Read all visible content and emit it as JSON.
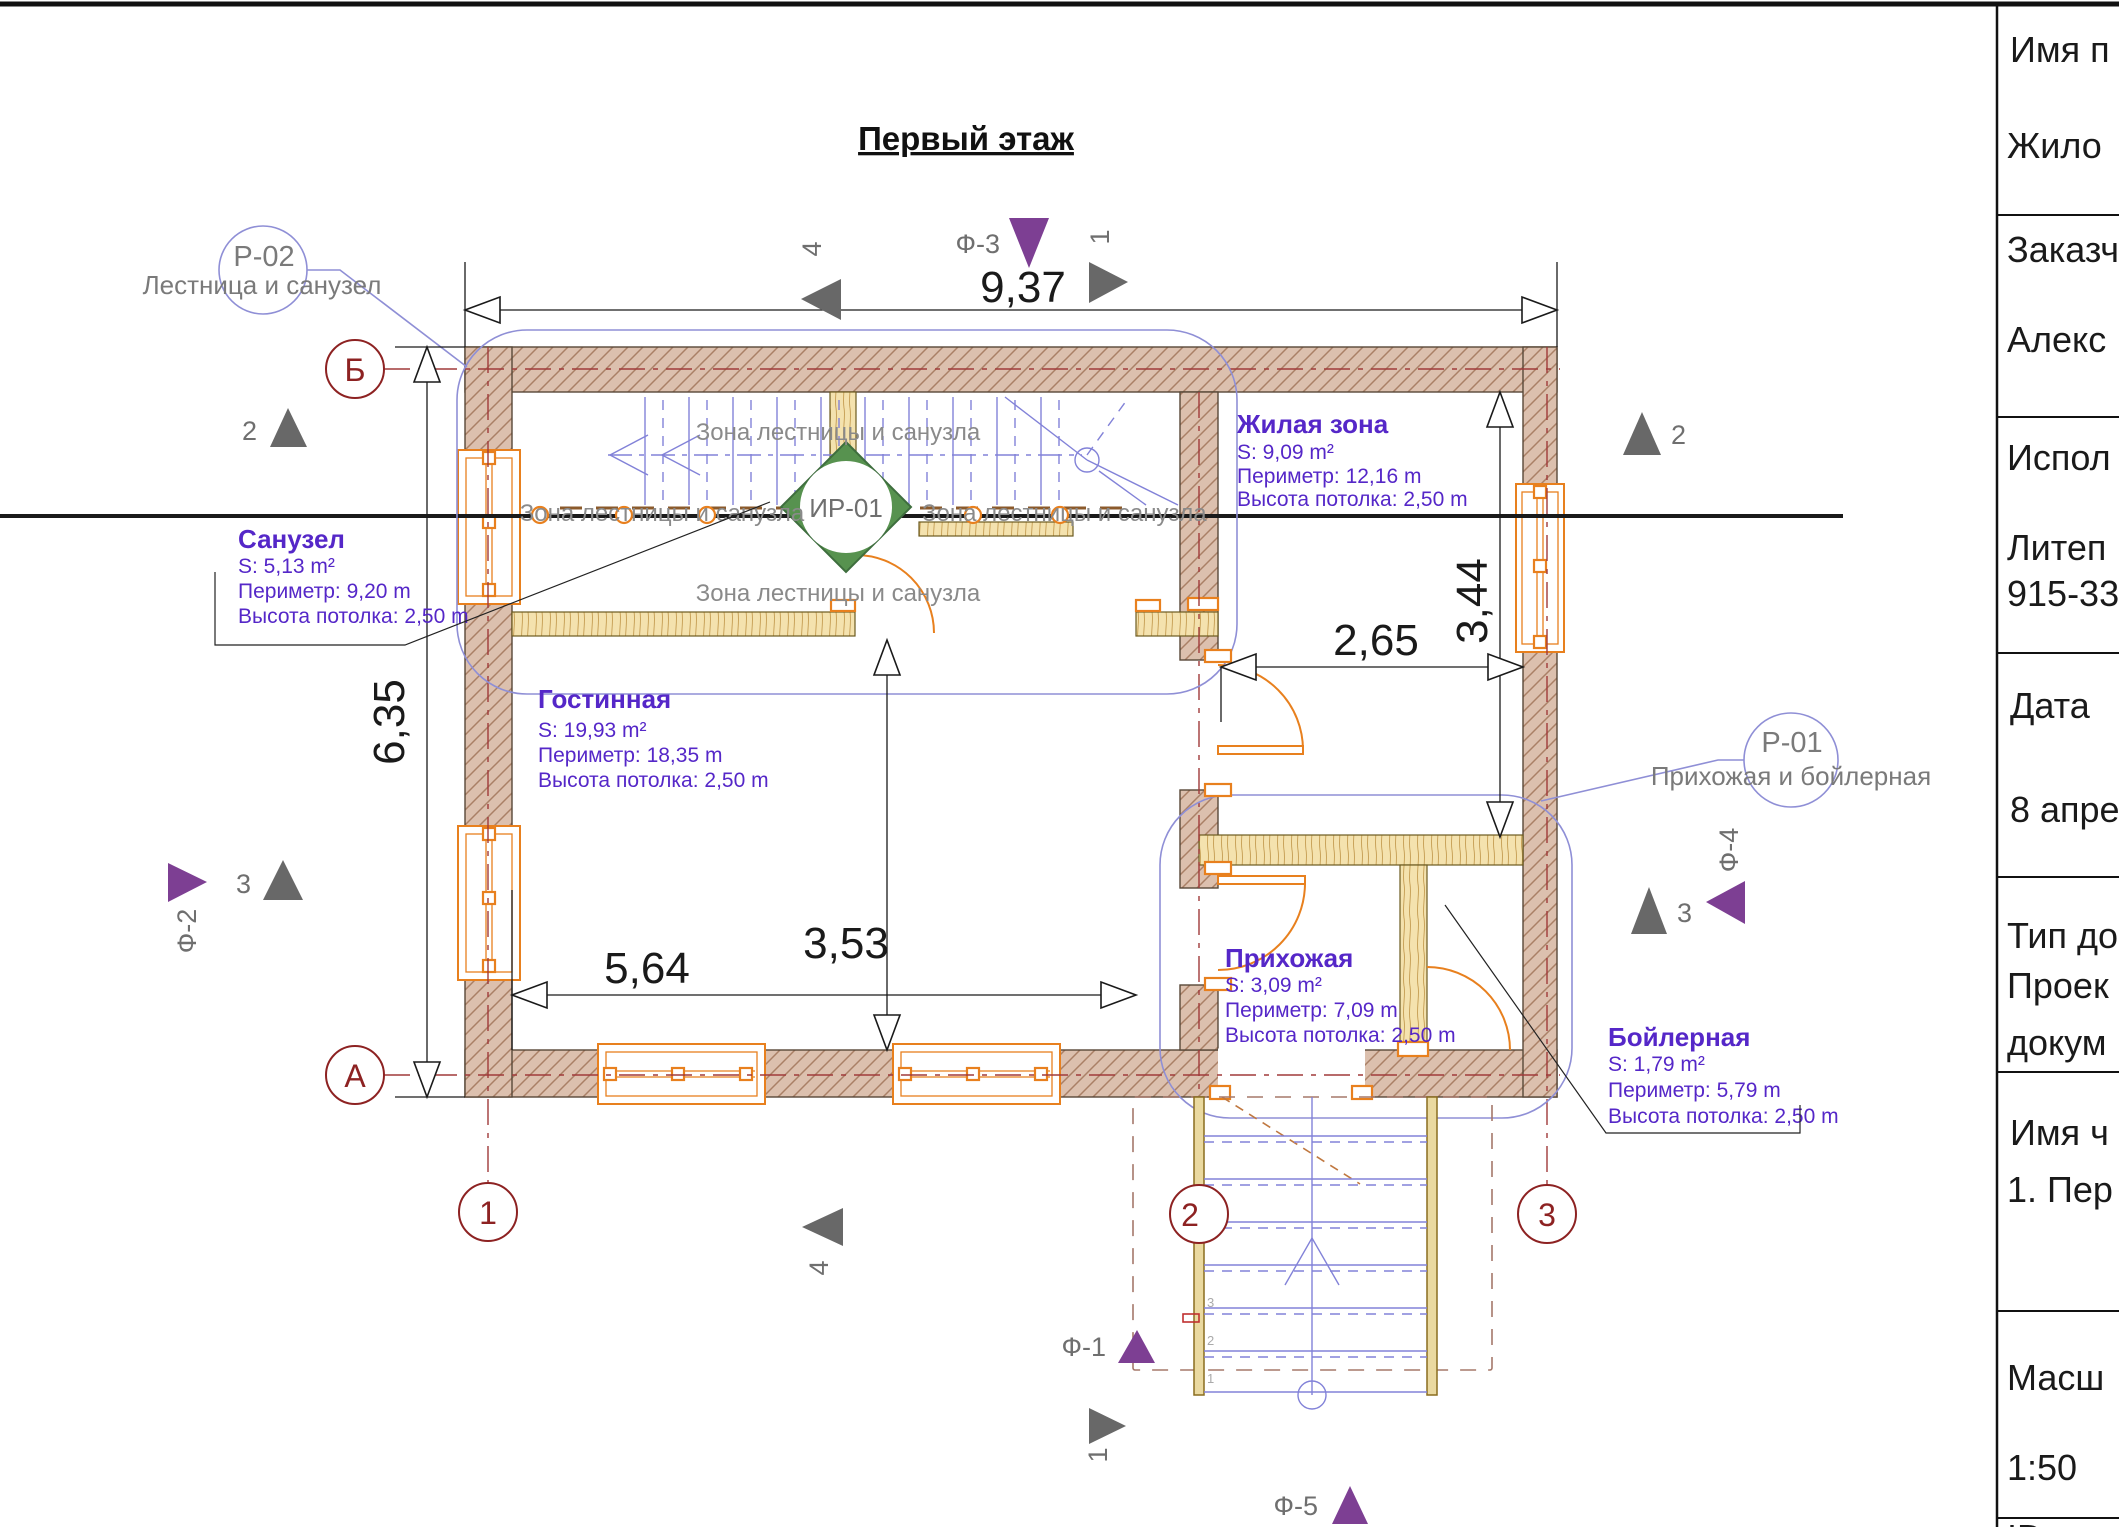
{
  "sheet_title": "Первый этаж",
  "titleblock": {
    "rows": [
      {
        "label": "Имя п",
        "value": "Жило",
        "value2": ""
      },
      {
        "label": "Заказч",
        "value": "Алекс",
        "value2": ""
      },
      {
        "label": "Испол",
        "value": "Литеп",
        "value2": "915-33"
      },
      {
        "label": "Дата",
        "value": "8 апре",
        "value2": ""
      },
      {
        "label": "Тип до",
        "value": "Проек",
        "value2": "докум"
      },
      {
        "label": "Имя ч",
        "value": "1. Пер",
        "value2": ""
      },
      {
        "label": "Масш",
        "value": "1:50",
        "value2": ""
      },
      {
        "label": "ID ма",
        "value": "",
        "value2": ""
      }
    ]
  },
  "rooms": {
    "sanuzel": {
      "name": "Санузел",
      "area": "S: 5,13 m²",
      "perimeter": "Периметр: 9,20 m",
      "ceiling": "Высота потолка: 2,50 m"
    },
    "gostinnaya": {
      "name": "Гостинная",
      "area": "S: 19,93 m²",
      "perimeter": "Периметр: 18,35 m",
      "ceiling": "Высота потолка: 2,50 m"
    },
    "zhilaya": {
      "name": "Жилая зона",
      "area": "S: 9,09 m²",
      "perimeter": "Периметр: 12,16 m",
      "ceiling": "Высота потолка: 2,50 m"
    },
    "prihozhaya": {
      "name": "Прихожая",
      "area": "S: 3,09 m²",
      "perimeter": "Периметр: 7,09 m",
      "ceiling": "Высота потолка: 2,50 m"
    },
    "boylernaya": {
      "name": "Бойлерная",
      "area": "S: 1,79 m²",
      "perimeter": "Периметр: 5,79 m",
      "ceiling": "Высота потолка: 2,50 m"
    }
  },
  "dims": {
    "top_width": "9,37",
    "left_height": "6,35",
    "living_right_height": "3,44",
    "hall_width": "2,65",
    "gost_width": "5,64",
    "gost_height": "3,53"
  },
  "axes": {
    "a": "А",
    "b": "Б",
    "n1": "1",
    "n2": "2",
    "n3": "3"
  },
  "callouts": {
    "p02": {
      "id": "Р-02",
      "label": "Лестница и санузел"
    },
    "p01": {
      "id": "Р-01",
      "label": "Прихожая и бойлерная"
    },
    "ir01": "ИР-01"
  },
  "zone_label": "Зона лестницы и санузла",
  "view_markers": {
    "m1": "1",
    "m2": "2",
    "m3": "3",
    "m4": "4"
  },
  "photo_markers": {
    "f1": "Ф-1",
    "f2": "Ф-2",
    "f3": "Ф-3",
    "f4": "Ф-4",
    "f5": "Ф-5"
  },
  "stair_steps": {
    "s1": "1",
    "s2": "2",
    "s3": "3"
  },
  "colors": {
    "wall": "#dcc0ae",
    "hatch": "#aa8066",
    "wood": "#f4e2ae",
    "accent_orange": "#e8801e",
    "stair_blue": "#8282d8",
    "axis_red": "#8d2222",
    "room_purple": "#5527c8",
    "marker_purple": "#7d3f93",
    "marker_gray": "#686868",
    "ir_green": "#57924f"
  }
}
